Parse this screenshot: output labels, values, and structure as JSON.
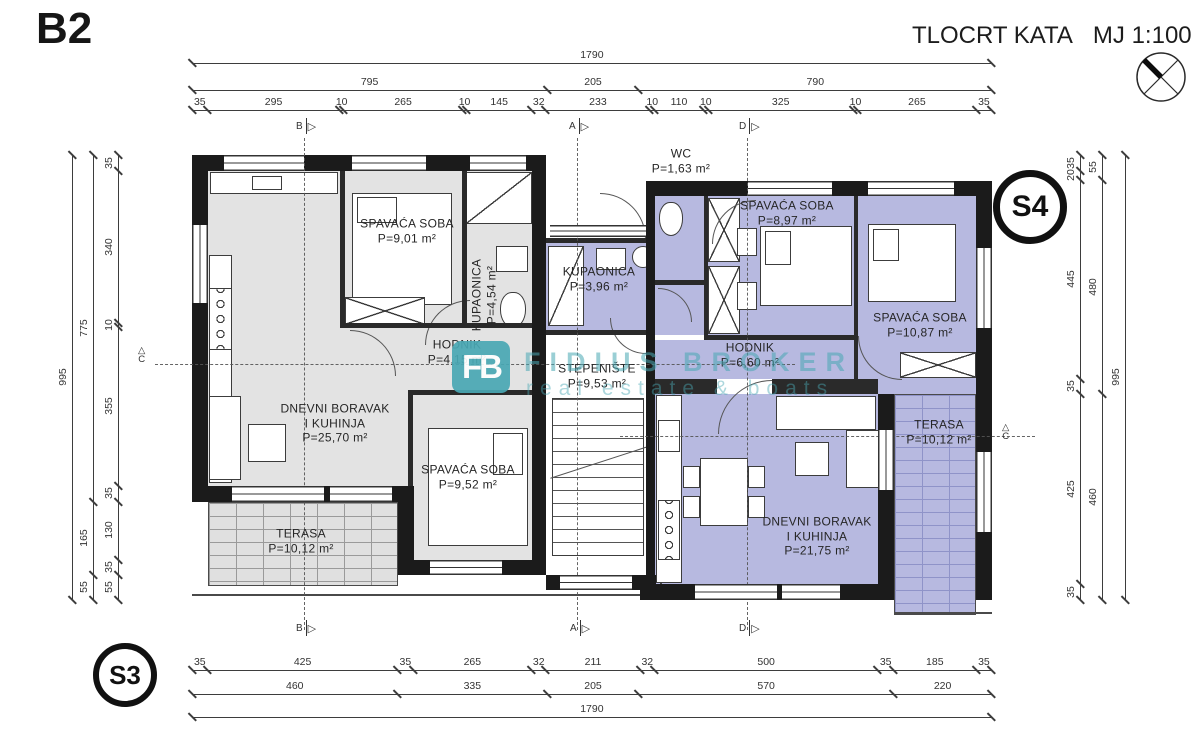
{
  "header": {
    "plan_code": "B2",
    "title": "TLOCRT KATA",
    "scale_label": "MJ 1:100"
  },
  "markers": {
    "s3": "S3",
    "s4": "S4"
  },
  "section_markers": {
    "letters": [
      "B",
      "A",
      "D",
      "C"
    ]
  },
  "rooms": [
    {
      "id": "spavaca1",
      "name_lines": [
        "SPAVAĆA SOBA"
      ],
      "area": "P=9,01 m²"
    },
    {
      "id": "kupaonica1",
      "name_lines": [
        "KUPAONICA"
      ],
      "area": "P=4,54 m²"
    },
    {
      "id": "hodnik1",
      "name_lines": [
        "HODNIK"
      ],
      "area": "P=4,15 m²"
    },
    {
      "id": "dnevni1",
      "name_lines": [
        "DNEVNI BORAVAK",
        "I KUHINJA"
      ],
      "area": "P=25,70 m²"
    },
    {
      "id": "spavaca2",
      "name_lines": [
        "SPAVAĆA SOBA"
      ],
      "area": "P=9,52 m²"
    },
    {
      "id": "terasa1",
      "name_lines": [
        "TERASA"
      ],
      "area": "P=10,12 m²"
    },
    {
      "id": "wc",
      "name_lines": [
        "WC"
      ],
      "area": "P=1,63 m²"
    },
    {
      "id": "kupaonica2",
      "name_lines": [
        "KUPAONICA"
      ],
      "area": "P=3,96 m²"
    },
    {
      "id": "stepeniste",
      "name_lines": [
        "STEPENIŠTE"
      ],
      "area": "P=9,53 m²"
    },
    {
      "id": "spavaca3",
      "name_lines": [
        "SPAVAĆA SOBA"
      ],
      "area": "P=8,97 m²"
    },
    {
      "id": "spavaca4",
      "name_lines": [
        "SPAVAĆA SOBA"
      ],
      "area": "P=10,87 m²"
    },
    {
      "id": "hodnik2",
      "name_lines": [
        "HODNIK"
      ],
      "area": "P=6,60 m²"
    },
    {
      "id": "dnevni2",
      "name_lines": [
        "DNEVNI BORAVAK",
        "I KUHINJA"
      ],
      "area": "P=21,75 m²"
    },
    {
      "id": "terasa2",
      "name_lines": [
        "TERASA"
      ],
      "area": "P=10,12 m²"
    }
  ],
  "dimensions": {
    "top": [
      [
        1790
      ],
      [
        795,
        205,
        790
      ],
      [
        35,
        295,
        10,
        265,
        10,
        145,
        32,
        233,
        10,
        110,
        10,
        325,
        10,
        265,
        35
      ]
    ],
    "bottom": [
      [
        35,
        425,
        35,
        265,
        32,
        211,
        32,
        500,
        35,
        185,
        35
      ],
      [
        460,
        335,
        205,
        570,
        220
      ],
      [
        1790
      ]
    ],
    "left": [
      [
        995
      ],
      [
        775,
        165,
        55
      ],
      [
        35,
        340,
        10,
        355,
        35,
        130,
        35,
        55
      ]
    ],
    "right": [
      [
        35,
        20,
        445,
        35,
        425,
        35
      ],
      [
        55,
        480,
        460
      ],
      [
        995
      ]
    ]
  },
  "watermark": {
    "logo": "FB",
    "line1": "FIDIUS BROKER",
    "line2": "real estate & boats"
  },
  "colors": {
    "left_fill": "#e3e3e3",
    "right_fill": "#b7b9e0",
    "watermark": "#49a8b4",
    "wall": "#1b1b1b"
  }
}
